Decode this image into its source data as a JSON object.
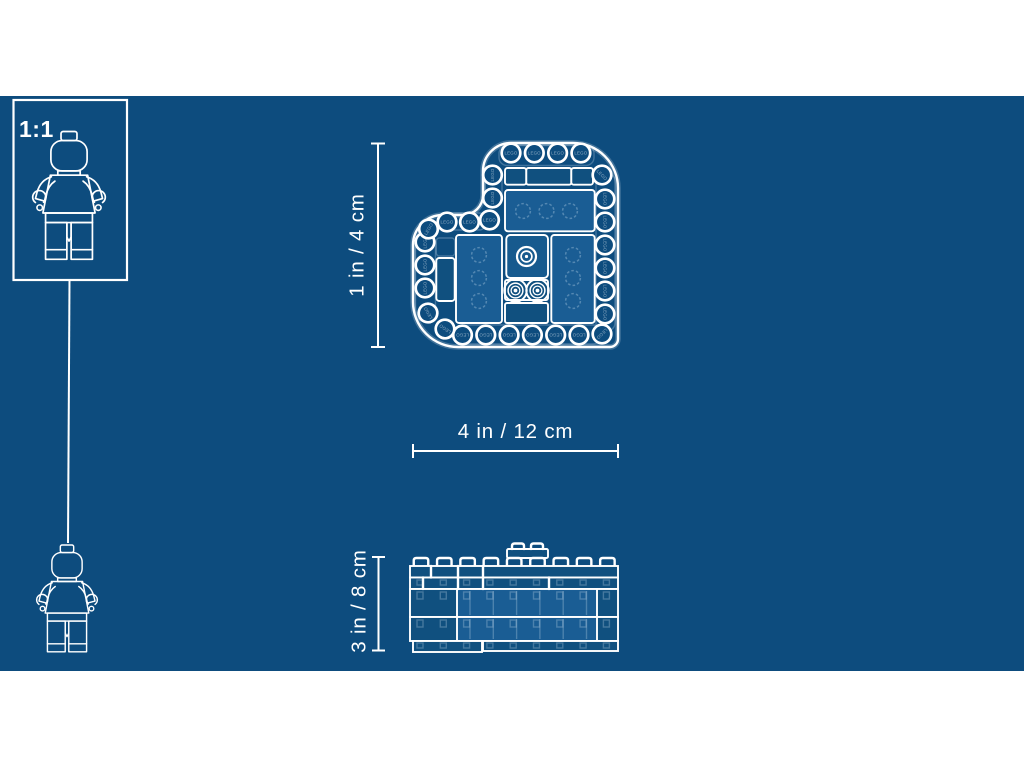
{
  "page": {
    "background_color": "#ffffff",
    "canvas_color": "#0d4c7e",
    "line_color": "#ffffff"
  },
  "scale_box": {
    "label": "1:1"
  },
  "stud_brand_label": "LEGO",
  "dimensions": {
    "top_view_height": "1 in / 4 cm",
    "top_view_width": "4 in / 12 cm",
    "side_view_height": "3 in / 8 cm"
  }
}
